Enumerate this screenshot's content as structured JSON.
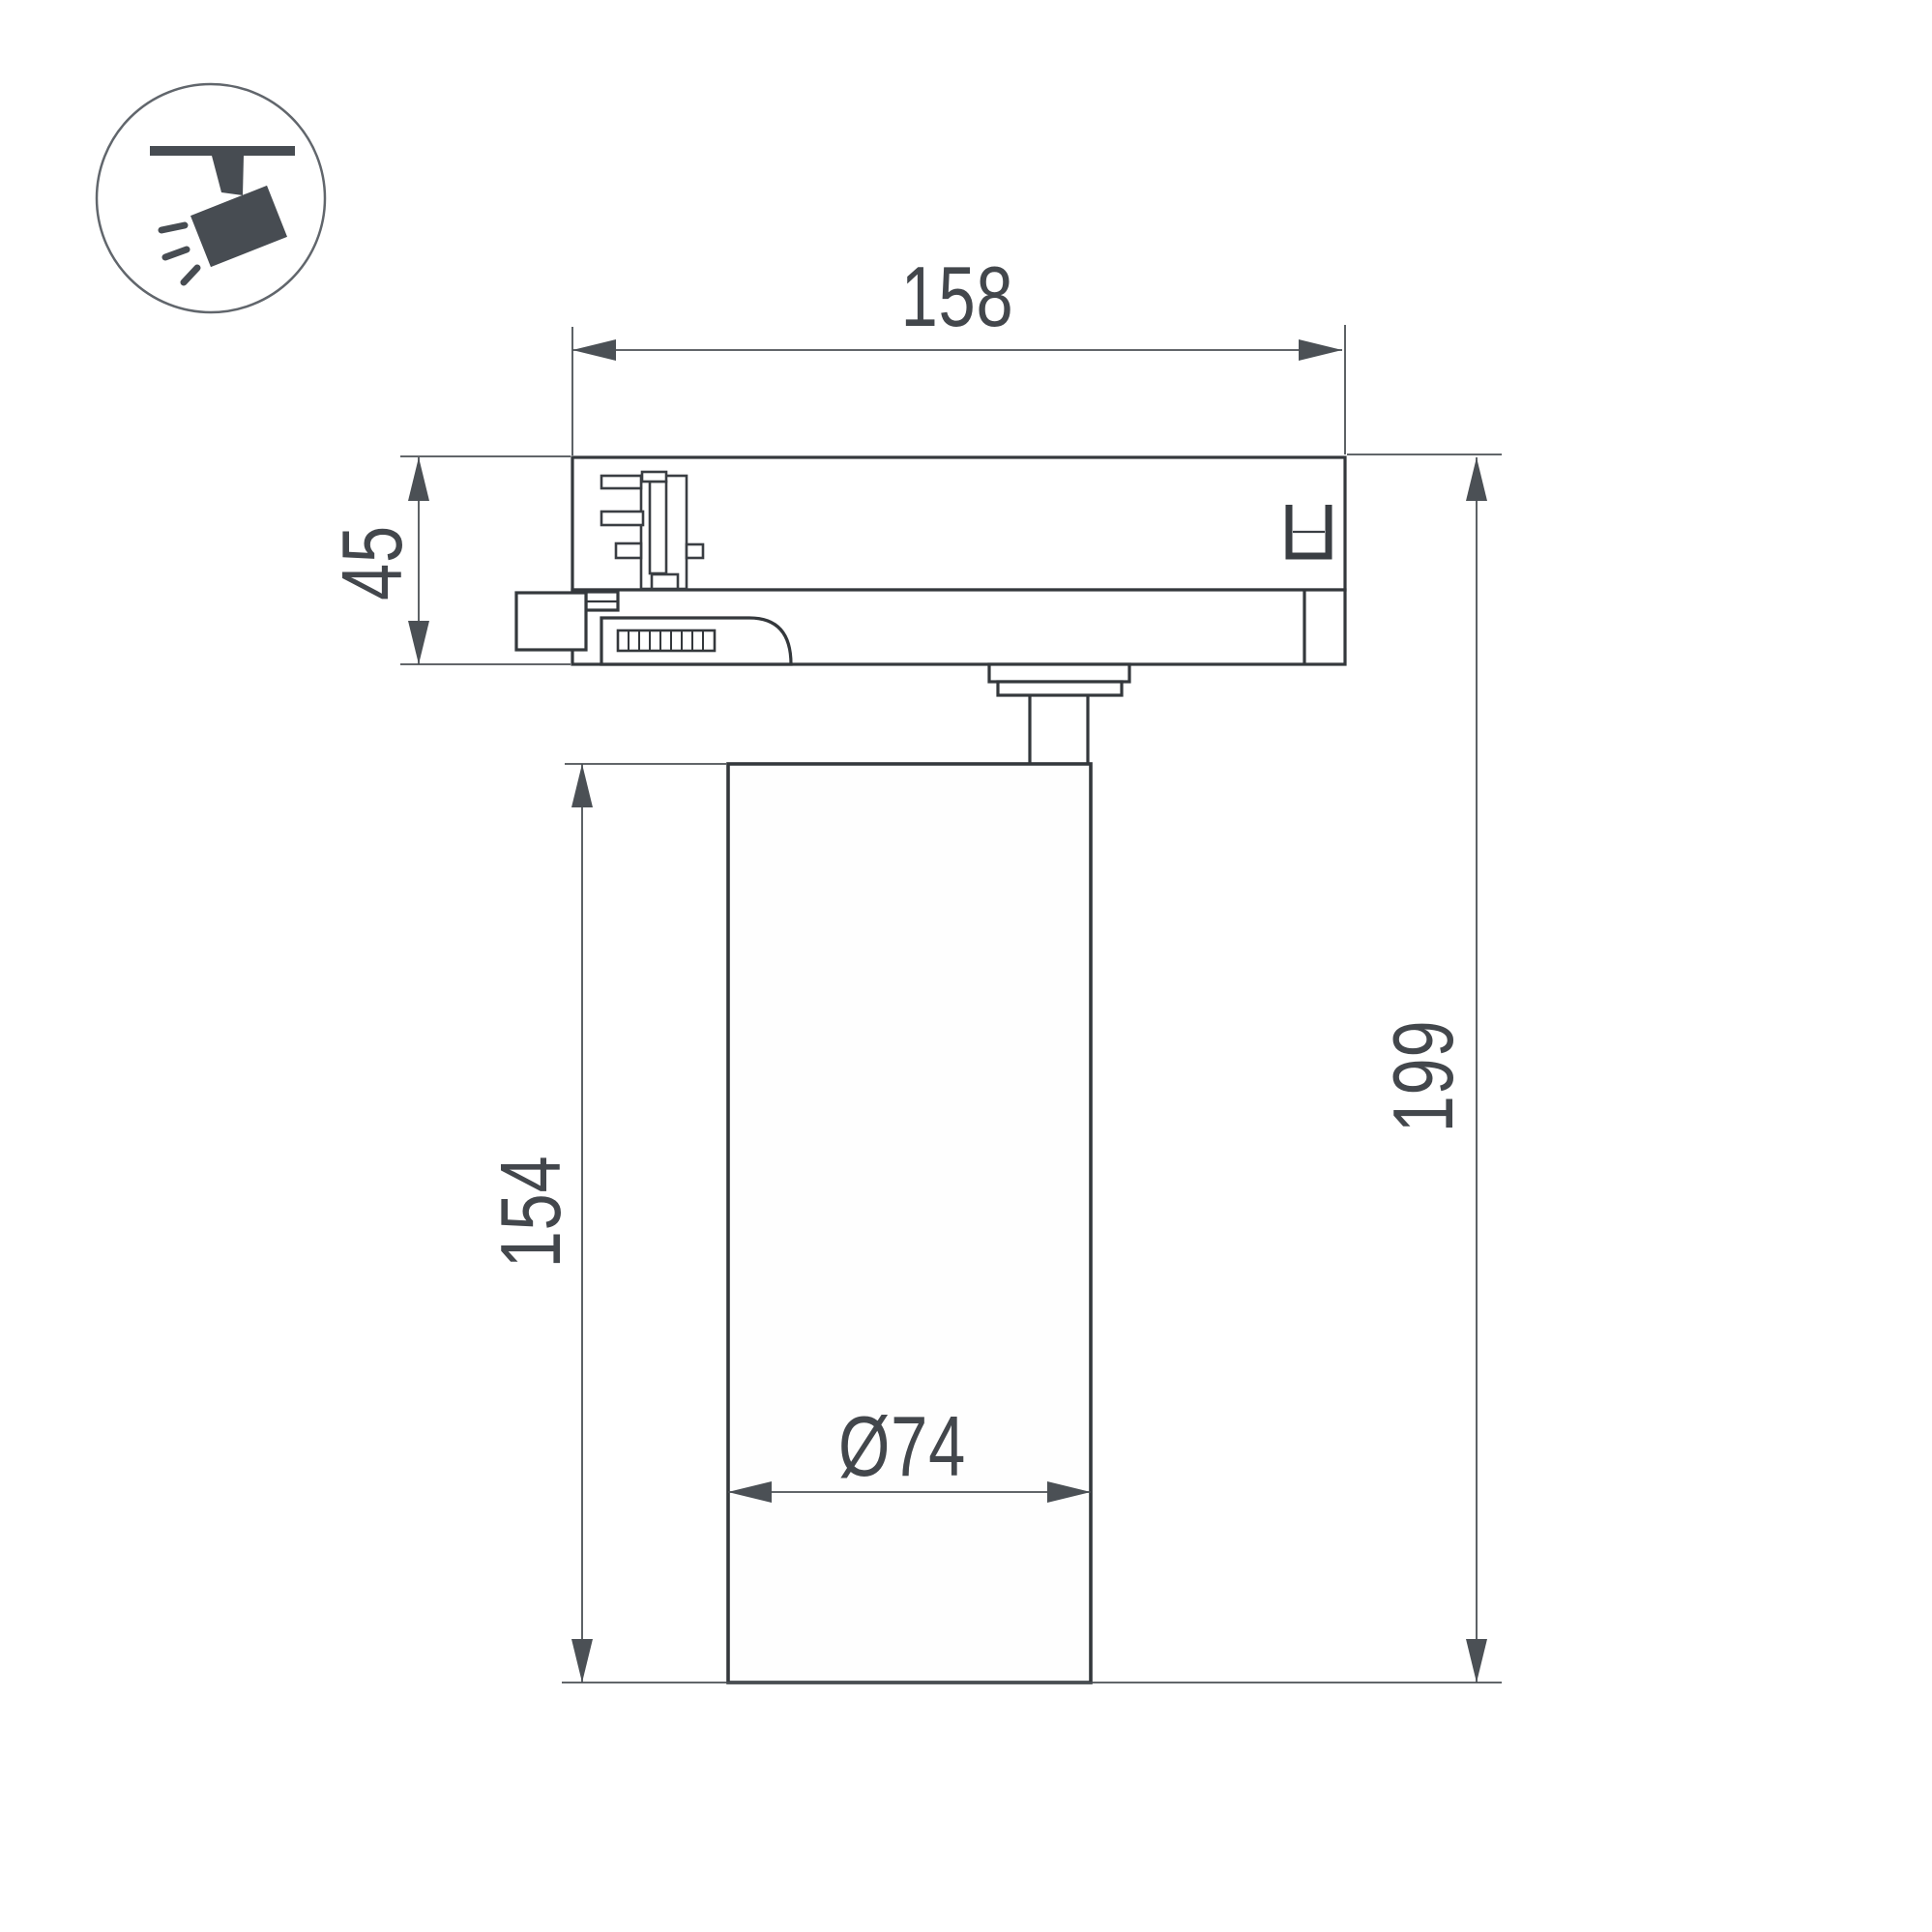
{
  "page": {
    "background": "#ffffff",
    "type": "technical-dimension-drawing",
    "subject": "LED track spotlight side view"
  },
  "icon": {
    "name": "track-spotlight-icon",
    "description": "ceiling track with tilted spotlight head and light rays"
  },
  "colors": {
    "outline": "#34383c",
    "detail_line": "#3a3e43",
    "dimension_line": "#4b5055",
    "text": "#43474c",
    "icon_fill": "#474c52",
    "icon_circle_stroke": "#61666c",
    "background": "#ffffff"
  },
  "dimensions": {
    "track_adapter_length": "158",
    "track_adapter_height": "45",
    "body_height": "154",
    "total_height": "199",
    "body_diameter": "Ø74"
  }
}
